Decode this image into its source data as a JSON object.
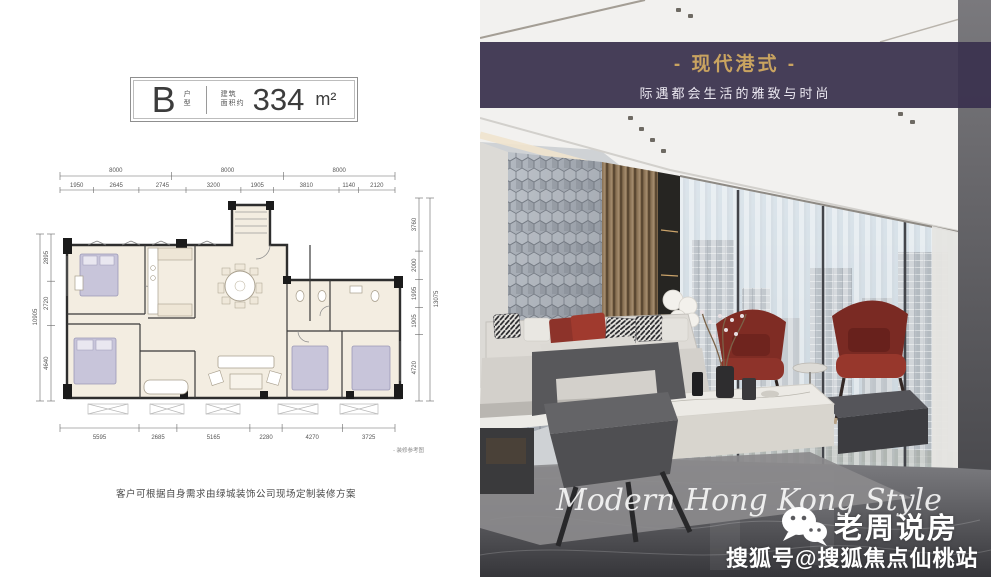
{
  "plan_header": {
    "unit_letter": "B",
    "unit_type_top": "户",
    "unit_type_bottom": "型",
    "area_prefix_line1": "建筑",
    "area_prefix_line2": "面积约",
    "area_value": "334",
    "area_unit": "m²"
  },
  "floorplan": {
    "dims_top_major": [
      "8000",
      "8000",
      "8000"
    ],
    "dims_top_minor": [
      "1950",
      "2645",
      "2745",
      "3200",
      "1905",
      "3810",
      "1140",
      "2120"
    ],
    "dims_bottom": [
      "5595",
      "2685",
      "5165",
      "2280",
      "4270",
      "3725"
    ],
    "dims_left_segments": [
      "2895",
      "2720",
      "4640"
    ],
    "dims_left_total": "10905",
    "dims_right_segments": [
      "3760",
      "2000",
      "1995",
      "1905",
      "4720"
    ],
    "dims_right_total": "13075",
    "reference_note": "- 装修参考图",
    "disclaimer": "客户可根据自身需求由绿城装饰公司现场定制装修方案"
  },
  "photo": {
    "banner": {
      "title": "- 现代港式 -",
      "subtitle": "际遇都会生活的雅致与时尚"
    },
    "watermark_script": "Modern Hong Kong Style",
    "brand": {
      "icon": "wechat-icon",
      "name": "老周说房",
      "handle": "搜狐号@搜狐焦点仙桃站"
    },
    "colors": {
      "banner_bg": "#3a324f",
      "banner_gold": "#c9a360",
      "armchair_red": "#7c2b24",
      "sofa_gray": "#d6d3ce",
      "floor_dark": "#3c3c40",
      "sky": "#c2d4e2"
    }
  }
}
